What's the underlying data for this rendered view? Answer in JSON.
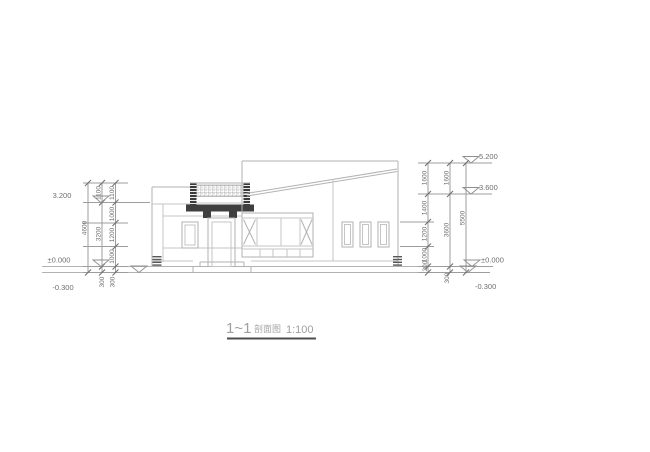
{
  "drawing": {
    "title_mark": "1~1",
    "title_name": "剖面图",
    "title_scale": "1:100"
  },
  "elevations": {
    "left": {
      "top": "3.200",
      "zero": "±0.000",
      "below": "-0.300"
    },
    "right": {
      "top": "5.200",
      "mid": "3.600",
      "zero": "±0.000",
      "below": "-0.300"
    }
  },
  "dims": {
    "left": {
      "overall": "4600",
      "mid": [
        "1100",
        "3200",
        "300"
      ],
      "inner": [
        "1100",
        "1000",
        "1200",
        "1000",
        "300"
      ]
    },
    "right": {
      "overall": "5500",
      "mid": [
        "1600",
        "3600",
        "300"
      ],
      "inner": [
        "1600",
        "1400",
        "1200",
        "1000",
        "300"
      ]
    }
  },
  "colors": {
    "building_line": "#b2b2b2",
    "dimension_line": "#9d9d9d",
    "dimension_text": "#6e6e6e",
    "section_cut_fill": "#3f3f3f",
    "title_underline": "#4d4d4d"
  }
}
